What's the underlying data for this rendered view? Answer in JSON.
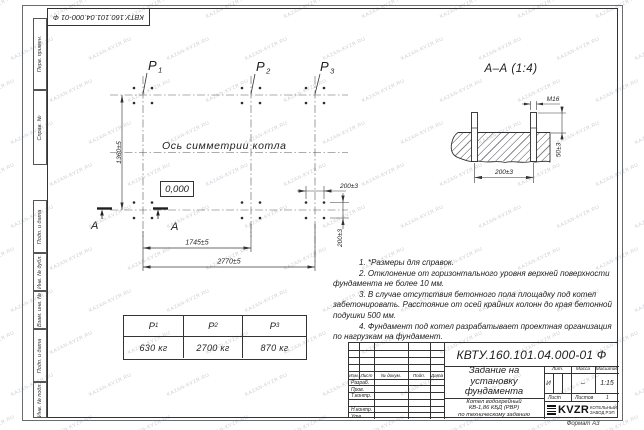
{
  "sheet": {
    "doc_number": "КВТУ.160.101.04.000-01 Ф",
    "format_note": "Формат А3",
    "watermark_text": "KAZAN-KVZR.RU"
  },
  "margin_columns": {
    "perv_primen": "Перв. примен.",
    "sprav_no": "Справ. №",
    "podp_data_1": "Подп. и дата",
    "inv_dubl": "Инв. № дубл.",
    "vzam_inv": "Взам. инв. №",
    "podp_data_2": "Подп. и дата",
    "inv_podl": "Инв. № подл."
  },
  "plan": {
    "symmetry_label": "Ось симметрии котла",
    "elevation": "0,000",
    "points": [
      {
        "name": "P",
        "sub": "1"
      },
      {
        "name": "P",
        "sub": "2"
      },
      {
        "name": "P",
        "sub": "3"
      }
    ],
    "dims": {
      "height": "1360±5",
      "span_p1_p2": "1745±5",
      "span_p1_p3": "2770±5",
      "bolt_x": "200±3",
      "bolt_y": "200±3"
    },
    "section_letter_left": "А",
    "section_letter_right": "А"
  },
  "section_view": {
    "title": "А–А (1:4)",
    "thread": "М16",
    "dim_protrusion": "50±3",
    "dim_spacing": "200±3"
  },
  "load_table": {
    "columns": [
      {
        "head": "P",
        "sub": "1",
        "value": "630 кг"
      },
      {
        "head": "P",
        "sub": "2",
        "value": "2700 кг"
      },
      {
        "head": "P",
        "sub": "3",
        "value": "870 кг"
      }
    ]
  },
  "notes": [
    "1. *Размеры для справок.",
    "2. Отклонение от горизонтального уровня верхней поверхности фундамента не более 10 мм.",
    "3. В случае отсутствия бетонного пола площадку под котел забетонировать. Расстояние от осей крайних колонн до края бетонной подушки 500 мм.",
    "4. Фундамент под котел разрабатывает проектная организация по нагрузкам на фундамент."
  ],
  "title_block": {
    "doc_number": "КВТУ.160.101.04.000-01 Ф",
    "title_lines": [
      "Задание на",
      "установку",
      "фундамента"
    ],
    "subject_lines": [
      "Котел водогрейный",
      "КВ-1,86 КБД (РВР)",
      "по техническому заданию"
    ],
    "cols": {
      "izm": "Изм.",
      "list": "Лист",
      "doc": "№ докум.",
      "podp": "Подп.",
      "data": "Дата"
    },
    "rows": {
      "razrab": "Разраб.",
      "prov": "Пров.",
      "tkontr": "Т.контр.",
      "nkontr": "Н.контр.",
      "utv": "Утв."
    },
    "lit_label": "Лит.",
    "lit": "И",
    "mass_label": "Масса",
    "mass": "–",
    "scale_label": "Масштаб",
    "scale": "1:15",
    "sheet_label": "Лист",
    "sheets_label": "Листов",
    "sheets": "1",
    "logo": "KVZR",
    "logo_caption_1": "КОТЕЛЬНЫЙ",
    "logo_caption_2": "ЗАВОД РЭП"
  }
}
